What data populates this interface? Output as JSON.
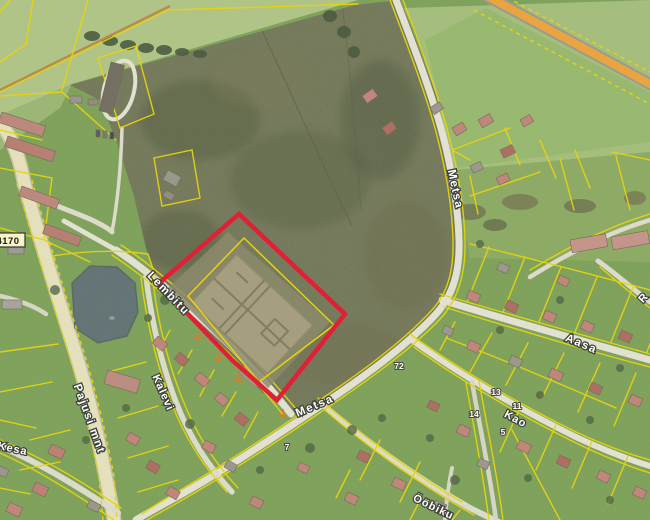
{
  "map": {
    "streets": {
      "lembitu": "Lembitu",
      "kalevi": "Kalevi",
      "pajusi": "Pajusi mnt",
      "metsa_upper": "Metsa",
      "metsa_lower": "Metsa",
      "aasa": "Aasa",
      "kao": "Kao",
      "oobiku": "Ööbiku",
      "kesa": "Kesa",
      "r_partial": "R"
    },
    "road_number_badge": "4170",
    "parcel_numbers": {
      "p72": "72",
      "p13": "13",
      "p11": "11",
      "p14": "14",
      "p5": "5",
      "p7": "7"
    },
    "colors": {
      "cadastral_line": "#edd900",
      "highlight_parcel": "#e8112d",
      "main_road_fill": "#f2a43a",
      "water": "#5f6f74"
    }
  }
}
